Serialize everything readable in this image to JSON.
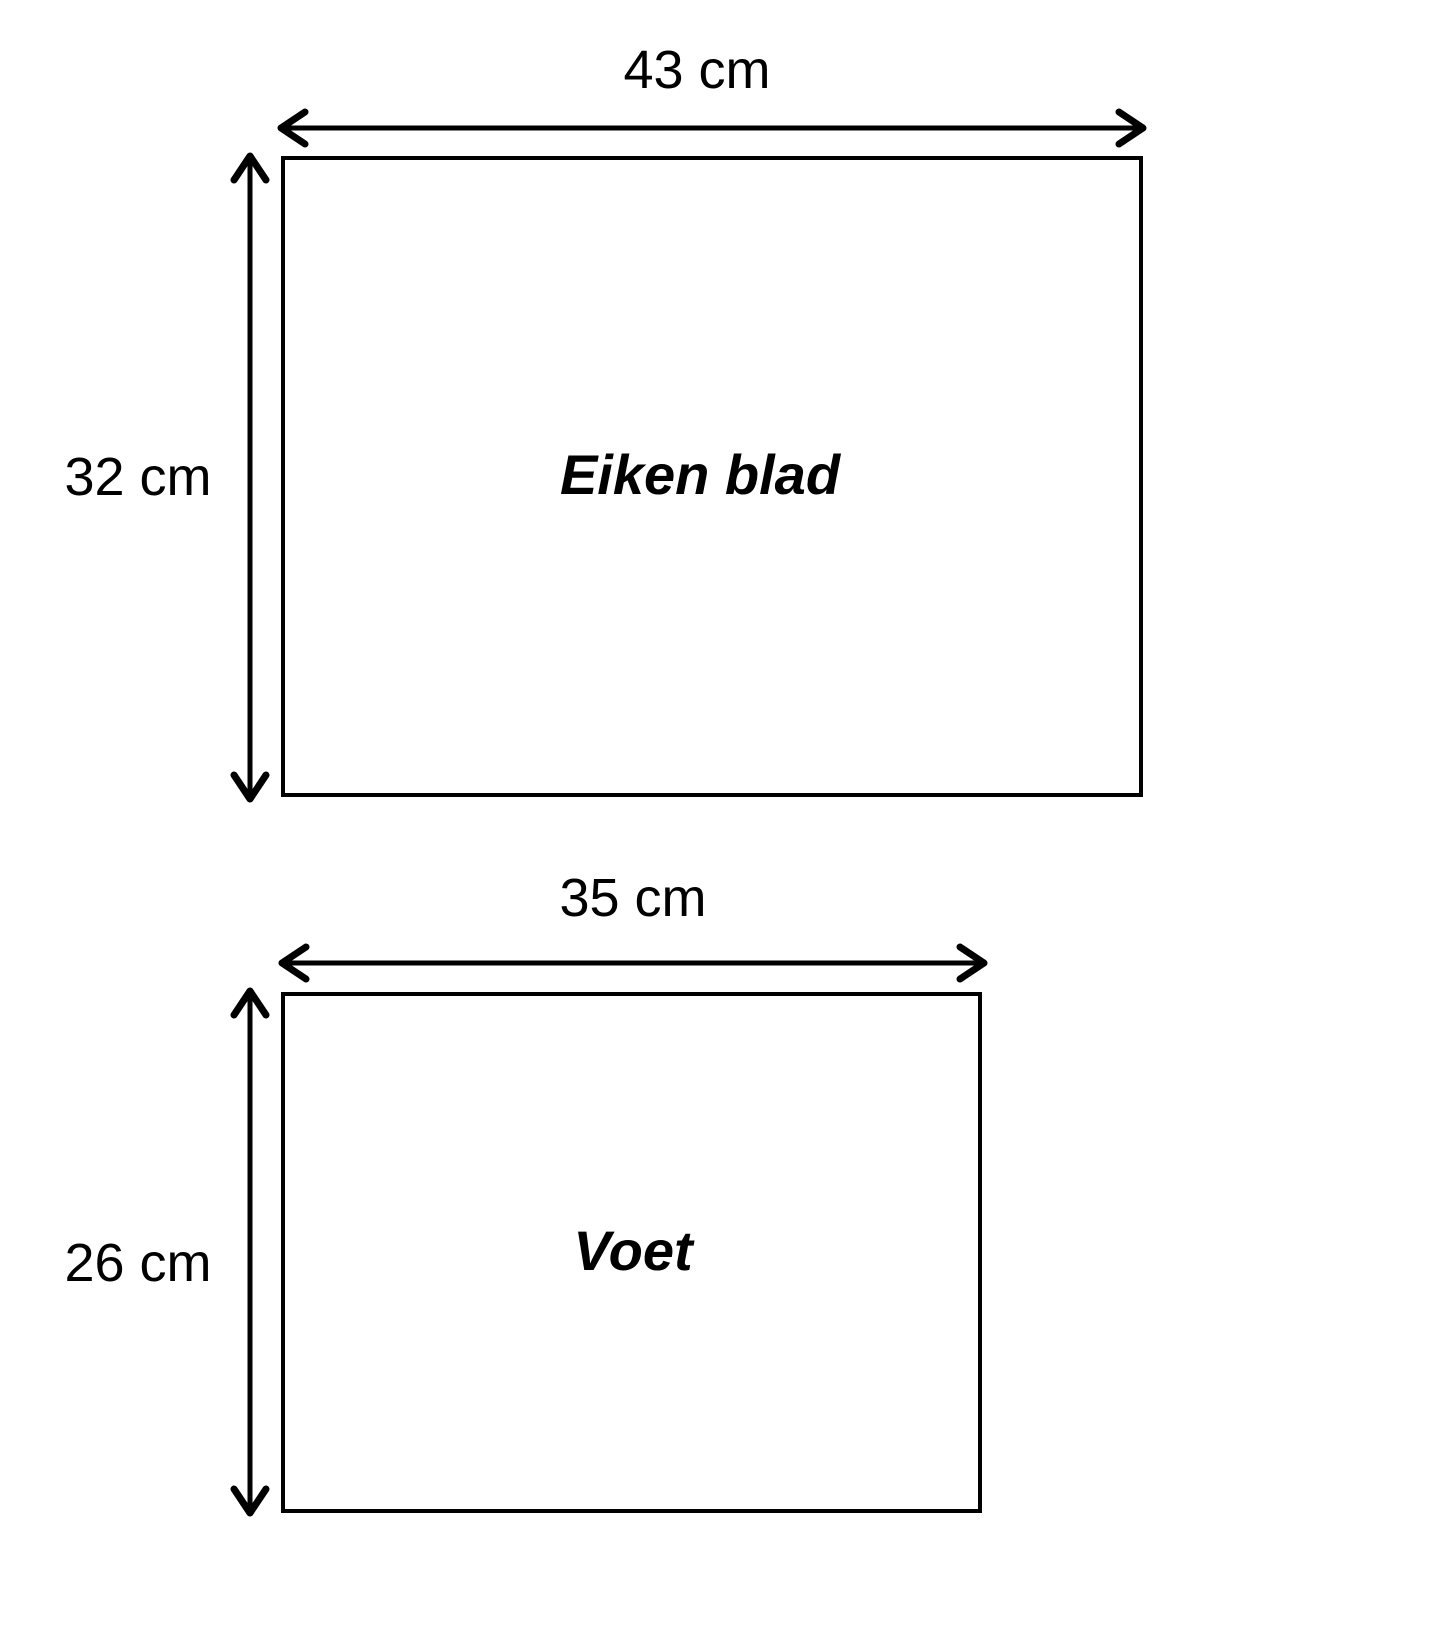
{
  "colors": {
    "ink": "#000000",
    "background": "#ffffff"
  },
  "shapes": [
    {
      "id": "eiken-blad",
      "label": "Eiken blad",
      "width_label": "43 cm",
      "height_label": "32 cm",
      "width_cm": 43,
      "height_cm": 32
    },
    {
      "id": "voet",
      "label": "Voet",
      "width_label": "35 cm",
      "height_label": "26 cm",
      "width_cm": 35,
      "height_cm": 26
    }
  ]
}
